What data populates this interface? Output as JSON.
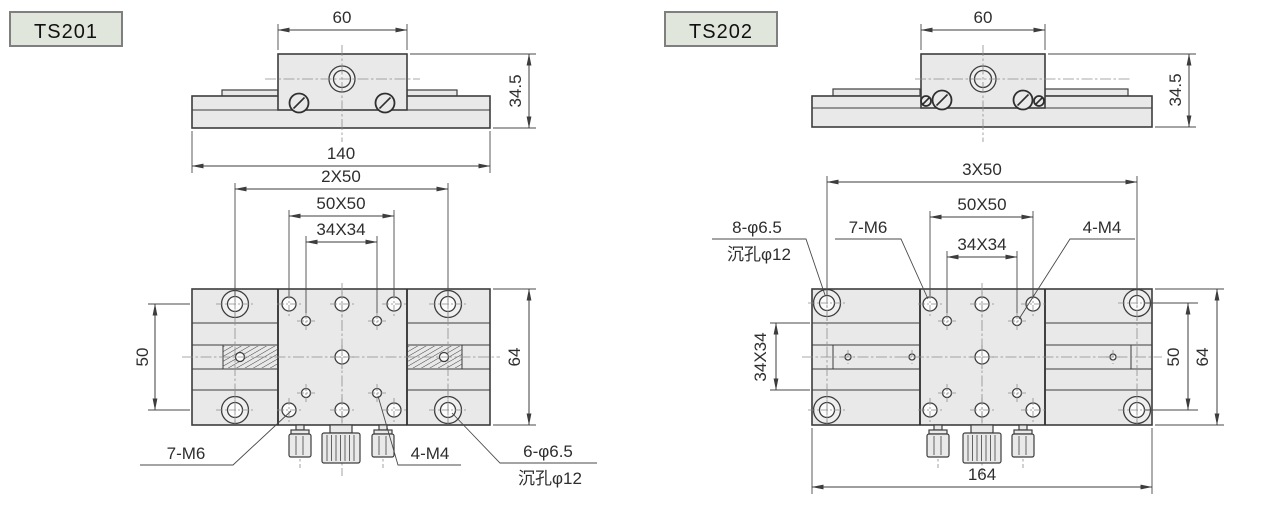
{
  "colors": {
    "background": "#ffffff",
    "part_fill": "#e9e9e9",
    "outline": "#3d3d3d",
    "centerline": "#8c8c8c",
    "dim_text": "#2e2e2e",
    "label_box_fill": "#e1e6dc",
    "label_box_border": "#7f7f7f"
  },
  "ts201": {
    "model_label": "TS201",
    "front_view": {
      "dim_top_width": "60",
      "dim_right_height": "34.5",
      "dim_bottom_width": "140"
    },
    "plan_view": {
      "dim_hole_span": "2X50",
      "dim_m6_grid": "50X50",
      "dim_m4_grid": "34X34",
      "dim_left_height": "50",
      "dim_right_height": "64",
      "callout_m6": "7-M6",
      "callout_m4": "4-M4",
      "callout_cbore_line1": "6-φ6.5",
      "callout_cbore_line2": "沉孔φ12"
    }
  },
  "ts202": {
    "model_label": "TS202",
    "front_view": {
      "dim_top_width": "60",
      "dim_right_height": "34.5"
    },
    "plan_view": {
      "dim_hole_span": "3X50",
      "dim_m6_grid": "50X50",
      "dim_m4_grid": "34X34",
      "dim_left_grid": "34X34",
      "dim_right_span": "50",
      "dim_right_height": "64",
      "dim_bottom_width": "164",
      "callout_cbore_line1": "8-φ6.5",
      "callout_cbore_line2": "沉孔φ12",
      "callout_m6": "7-M6",
      "callout_m4": "4-M4"
    }
  }
}
